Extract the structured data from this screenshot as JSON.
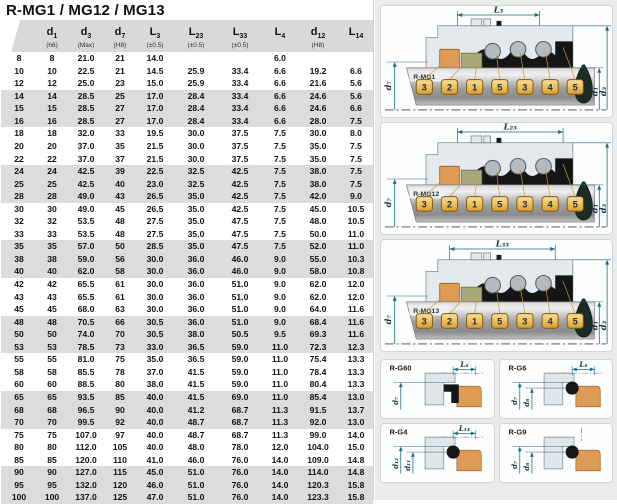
{
  "title": "R-MG1 / MG12 / MG13",
  "colors": {
    "dimension_accent": "#1a6a85",
    "stripe_gray": "#dcdcdc",
    "header_band": "#d9d9d9",
    "panel_background": "#e9ebec",
    "elastomer_orange": "#df9b55",
    "seal_face_olive": "#a9aa7c",
    "tag_gold": "#efc25c"
  },
  "table": {
    "columns": [
      {
        "main": "d",
        "sub": "1",
        "tol": "(h6)"
      },
      {
        "main": "d",
        "sub": "3",
        "tol": "(Max)"
      },
      {
        "main": "d",
        "sub": "7",
        "tol": "(H8)"
      },
      {
        "main": "L",
        "sub": "3",
        "tol": "(±0.5)"
      },
      {
        "main": "L",
        "sub": "23",
        "tol": "(±0.5)"
      },
      {
        "main": "L",
        "sub": "33",
        "tol": "(±0.5)"
      },
      {
        "main": "L",
        "sub": "4",
        "tol": ""
      },
      {
        "main": "d",
        "sub": "12",
        "tol": "(H8)"
      },
      {
        "main": "L",
        "sub": "14",
        "tol": ""
      }
    ],
    "rows": [
      {
        "size": "8",
        "values": [
          "8",
          "21.0",
          "21",
          "14.0",
          "",
          "",
          "6.0",
          "",
          ""
        ]
      },
      {
        "size": "10",
        "values": [
          "10",
          "22.5",
          "21",
          "14.5",
          "25.9",
          "33.4",
          "6.6",
          "19.2",
          "6.6"
        ]
      },
      {
        "size": "12",
        "values": [
          "12",
          "25.0",
          "23",
          "15.0",
          "25.9",
          "33.4",
          "6.6",
          "21.6",
          "5.6"
        ]
      },
      {
        "size": "14",
        "values": [
          "14",
          "28.5",
          "25",
          "17.0",
          "28.4",
          "33.4",
          "6.6",
          "24.6",
          "5.6"
        ]
      },
      {
        "size": "15",
        "values": [
          "15",
          "28.5",
          "27",
          "17.0",
          "28.4",
          "33.4",
          "6.6",
          "24.6",
          "6.6"
        ]
      },
      {
        "size": "16",
        "values": [
          "16",
          "28.5",
          "27",
          "17.0",
          "28.4",
          "33.4",
          "6.6",
          "28.0",
          "7.5"
        ]
      },
      {
        "size": "18",
        "values": [
          "18",
          "32.0",
          "33",
          "19.5",
          "30.0",
          "37.5",
          "7.5",
          "30.0",
          "8.0"
        ]
      },
      {
        "size": "20",
        "values": [
          "20",
          "37.0",
          "35",
          "21.5",
          "30.0",
          "37.5",
          "7.5",
          "35.0",
          "7.5"
        ]
      },
      {
        "size": "22",
        "values": [
          "22",
          "37.0",
          "37",
          "21.5",
          "30.0",
          "37.5",
          "7.5",
          "35.0",
          "7.5"
        ]
      },
      {
        "size": "24",
        "values": [
          "24",
          "42.5",
          "39",
          "22.5",
          "32.5",
          "42.5",
          "7.5",
          "38.0",
          "7.5"
        ]
      },
      {
        "size": "25",
        "values": [
          "25",
          "42.5",
          "40",
          "23.0",
          "32.5",
          "42.5",
          "7.5",
          "38.0",
          "7.5"
        ]
      },
      {
        "size": "28",
        "values": [
          "28",
          "49.0",
          "43",
          "26.5",
          "35.0",
          "42.5",
          "7.5",
          "42.0",
          "9.0"
        ]
      },
      {
        "size": "30",
        "values": [
          "30",
          "49.0",
          "45",
          "26.5",
          "35.0",
          "42.5",
          "7.5",
          "45.0",
          "10.5"
        ]
      },
      {
        "size": "32",
        "values": [
          "32",
          "53.5",
          "48",
          "27.5",
          "35.0",
          "47.5",
          "7.5",
          "48.0",
          "10.5"
        ]
      },
      {
        "size": "33",
        "values": [
          "33",
          "53.5",
          "48",
          "27.5",
          "35.0",
          "47.5",
          "7.5",
          "50.0",
          "11.0"
        ]
      },
      {
        "size": "35",
        "values": [
          "35",
          "57.0",
          "50",
          "28.5",
          "35.0",
          "47.5",
          "7.5",
          "52.0",
          "11.0"
        ]
      },
      {
        "size": "38",
        "values": [
          "38",
          "59.0",
          "56",
          "30.0",
          "36.0",
          "46.0",
          "9.0",
          "55.0",
          "10.3"
        ]
      },
      {
        "size": "40",
        "values": [
          "40",
          "62.0",
          "58",
          "30.0",
          "36.0",
          "46.0",
          "9.0",
          "58.0",
          "10.8"
        ]
      },
      {
        "size": "42",
        "values": [
          "42",
          "65.5",
          "61",
          "30.0",
          "36.0",
          "51.0",
          "9.0",
          "62.0",
          "12.0"
        ]
      },
      {
        "size": "43",
        "values": [
          "43",
          "65.5",
          "61",
          "30.0",
          "36.0",
          "51.0",
          "9.0",
          "62.0",
          "12.0"
        ]
      },
      {
        "size": "45",
        "values": [
          "45",
          "68.0",
          "63",
          "30.0",
          "36.0",
          "51.0",
          "9.0",
          "64.0",
          "11.6"
        ]
      },
      {
        "size": "48",
        "values": [
          "48",
          "70.5",
          "66",
          "30.5",
          "36.0",
          "51.0",
          "9.0",
          "68.4",
          "11.6"
        ]
      },
      {
        "size": "50",
        "values": [
          "50",
          "74.0",
          "70",
          "30.5",
          "38.0",
          "50.5",
          "9.5",
          "69.3",
          "11.6"
        ]
      },
      {
        "size": "53",
        "values": [
          "53",
          "78.5",
          "73",
          "33.0",
          "36.5",
          "59.0",
          "11.0",
          "72.3",
          "12.3"
        ]
      },
      {
        "size": "55",
        "values": [
          "55",
          "81.0",
          "75",
          "35.0",
          "36.5",
          "59.0",
          "11.0",
          "75.4",
          "13.3"
        ]
      },
      {
        "size": "58",
        "values": [
          "58",
          "85.5",
          "78",
          "37.0",
          "41.5",
          "59.0",
          "11.0",
          "78.4",
          "13.3"
        ]
      },
      {
        "size": "60",
        "values": [
          "60",
          "88.5",
          "80",
          "38.0",
          "41.5",
          "59.0",
          "11.0",
          "80.4",
          "13.3"
        ]
      },
      {
        "size": "65",
        "values": [
          "65",
          "93.5",
          "85",
          "40.0",
          "41.5",
          "69.0",
          "11.0",
          "85.4",
          "13.0"
        ]
      },
      {
        "size": "68",
        "values": [
          "68",
          "96.5",
          "90",
          "40.0",
          "41.2",
          "68.7",
          "11.3",
          "91.5",
          "13.7"
        ]
      },
      {
        "size": "70",
        "values": [
          "70",
          "99.5",
          "92",
          "40.0",
          "48.7",
          "68.7",
          "11.3",
          "92.0",
          "13.0"
        ]
      },
      {
        "size": "75",
        "values": [
          "75",
          "107.0",
          "97",
          "40.0",
          "48.7",
          "68.7",
          "11.3",
          "99.0",
          "14.0"
        ]
      },
      {
        "size": "80",
        "values": [
          "80",
          "112.0",
          "105",
          "40.0",
          "48.0",
          "78.0",
          "12.0",
          "104.0",
          "15.0"
        ]
      },
      {
        "size": "85",
        "values": [
          "85",
          "120.0",
          "110",
          "41.0",
          "46.0",
          "76.0",
          "14.0",
          "109.0",
          "14.8"
        ]
      },
      {
        "size": "90",
        "values": [
          "90",
          "127.0",
          "115",
          "45.0",
          "51.0",
          "76.0",
          "14.0",
          "114.0",
          "14.8"
        ]
      },
      {
        "size": "95",
        "values": [
          "95",
          "132.0",
          "120",
          "46.0",
          "51.0",
          "76.0",
          "14.0",
          "120.3",
          "15.8"
        ]
      },
      {
        "size": "100",
        "values": [
          "100",
          "137.0",
          "125",
          "47.0",
          "51.0",
          "76.0",
          "14.0",
          "123.3",
          "15.8"
        ]
      }
    ]
  },
  "diagrams": [
    {
      "name": "R-MG1",
      "top_dim": "L₃",
      "left_dim": "d₇",
      "right_dims": [
        "d₁",
        "d₃"
      ],
      "part_numbers": [
        "3",
        "2",
        "1",
        "5",
        "3",
        "4",
        "5"
      ]
    },
    {
      "name": "R-MG12",
      "top_dim": "L₂₃",
      "left_dim": "d₇",
      "right_dims": [
        "d₁",
        "d₃"
      ],
      "part_numbers": [
        "3",
        "2",
        "1",
        "5",
        "3",
        "4",
        "5"
      ]
    },
    {
      "name": "R-MG13",
      "top_dim": "L₃₃",
      "left_dim": "d₇",
      "right_dims": [
        "d₁",
        "d₃"
      ],
      "part_numbers": [
        "3",
        "2",
        "1",
        "5",
        "3",
        "4",
        "5"
      ]
    }
  ],
  "seats": [
    {
      "name": "R-G60",
      "top_dim": "L₄",
      "dims": [
        "d₇"
      ],
      "type": "block"
    },
    {
      "name": "R-G6",
      "top_dim": "L₄",
      "dims": [
        "d₇",
        "d₈"
      ],
      "type": "oring"
    },
    {
      "name": "R-G4",
      "top_dim": "L₁₄",
      "dims": [
        "d₁₂",
        "d₁₁"
      ],
      "type": "oring"
    },
    {
      "name": "R-G9",
      "top_dim": "",
      "dims": [
        "d₇",
        "d₈"
      ],
      "type": "oring"
    }
  ]
}
